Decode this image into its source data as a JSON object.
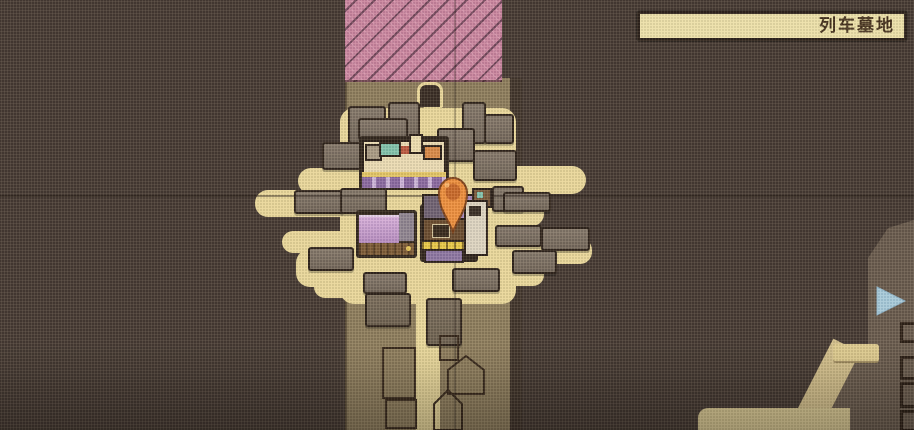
{
  "screen": {
    "type": "game-map",
    "region_label": "列车墓地",
    "icons": {
      "player_pin": "location-pin-icon",
      "exit_arrow": "map-exit-arrow-right-icon",
      "gate": "arch-gate-icon"
    },
    "colors": {
      "background": "#463b34",
      "corridor_ground": "#8d7d5d",
      "path_tan": "#e8d79b",
      "hazard_pink": "#c9849f",
      "block_gray": "#7b6f63",
      "outline_dark": "#30251d",
      "label_bg": "#ece0aa",
      "label_border": "#2f241d",
      "label_text": "#45321f",
      "pin_orange": "#ec8f3e",
      "arrow_blue": "#a6c9da",
      "east_region": "#695b4e"
    }
  }
}
